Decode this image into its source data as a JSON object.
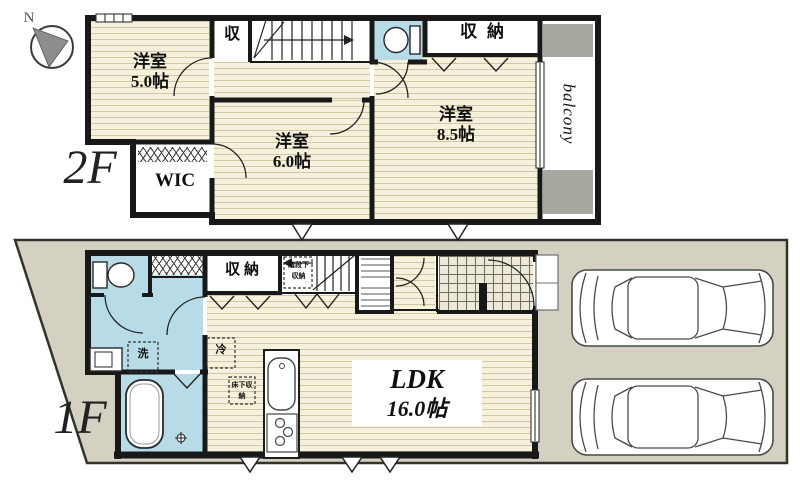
{
  "compass": {
    "north": "N"
  },
  "floor2": {
    "label": "2F",
    "bedroom5": {
      "name": "洋室",
      "size": "5.0帖"
    },
    "bedroom6": {
      "name": "洋室",
      "size": "6.0帖"
    },
    "bedroom85": {
      "name": "洋室",
      "size": "8.5帖"
    },
    "closet": "収",
    "storage": "収納",
    "wic": "WIC",
    "balcony": "balcony"
  },
  "floor1": {
    "label": "1F",
    "ldk": {
      "name": "LDK",
      "size": "16.0帖"
    },
    "storage": "収納",
    "under_stairs_storage": "階段下収納",
    "floor_storage": "床下収納",
    "fridge": "冷",
    "washer": "洗"
  },
  "colors": {
    "wood_floor": "#f6f1dc",
    "wet_area_blue": "#b7dbe7",
    "lot_ground": "#d4d0c2",
    "wall": "#181818",
    "gray_fill": "#a8a7a0"
  }
}
